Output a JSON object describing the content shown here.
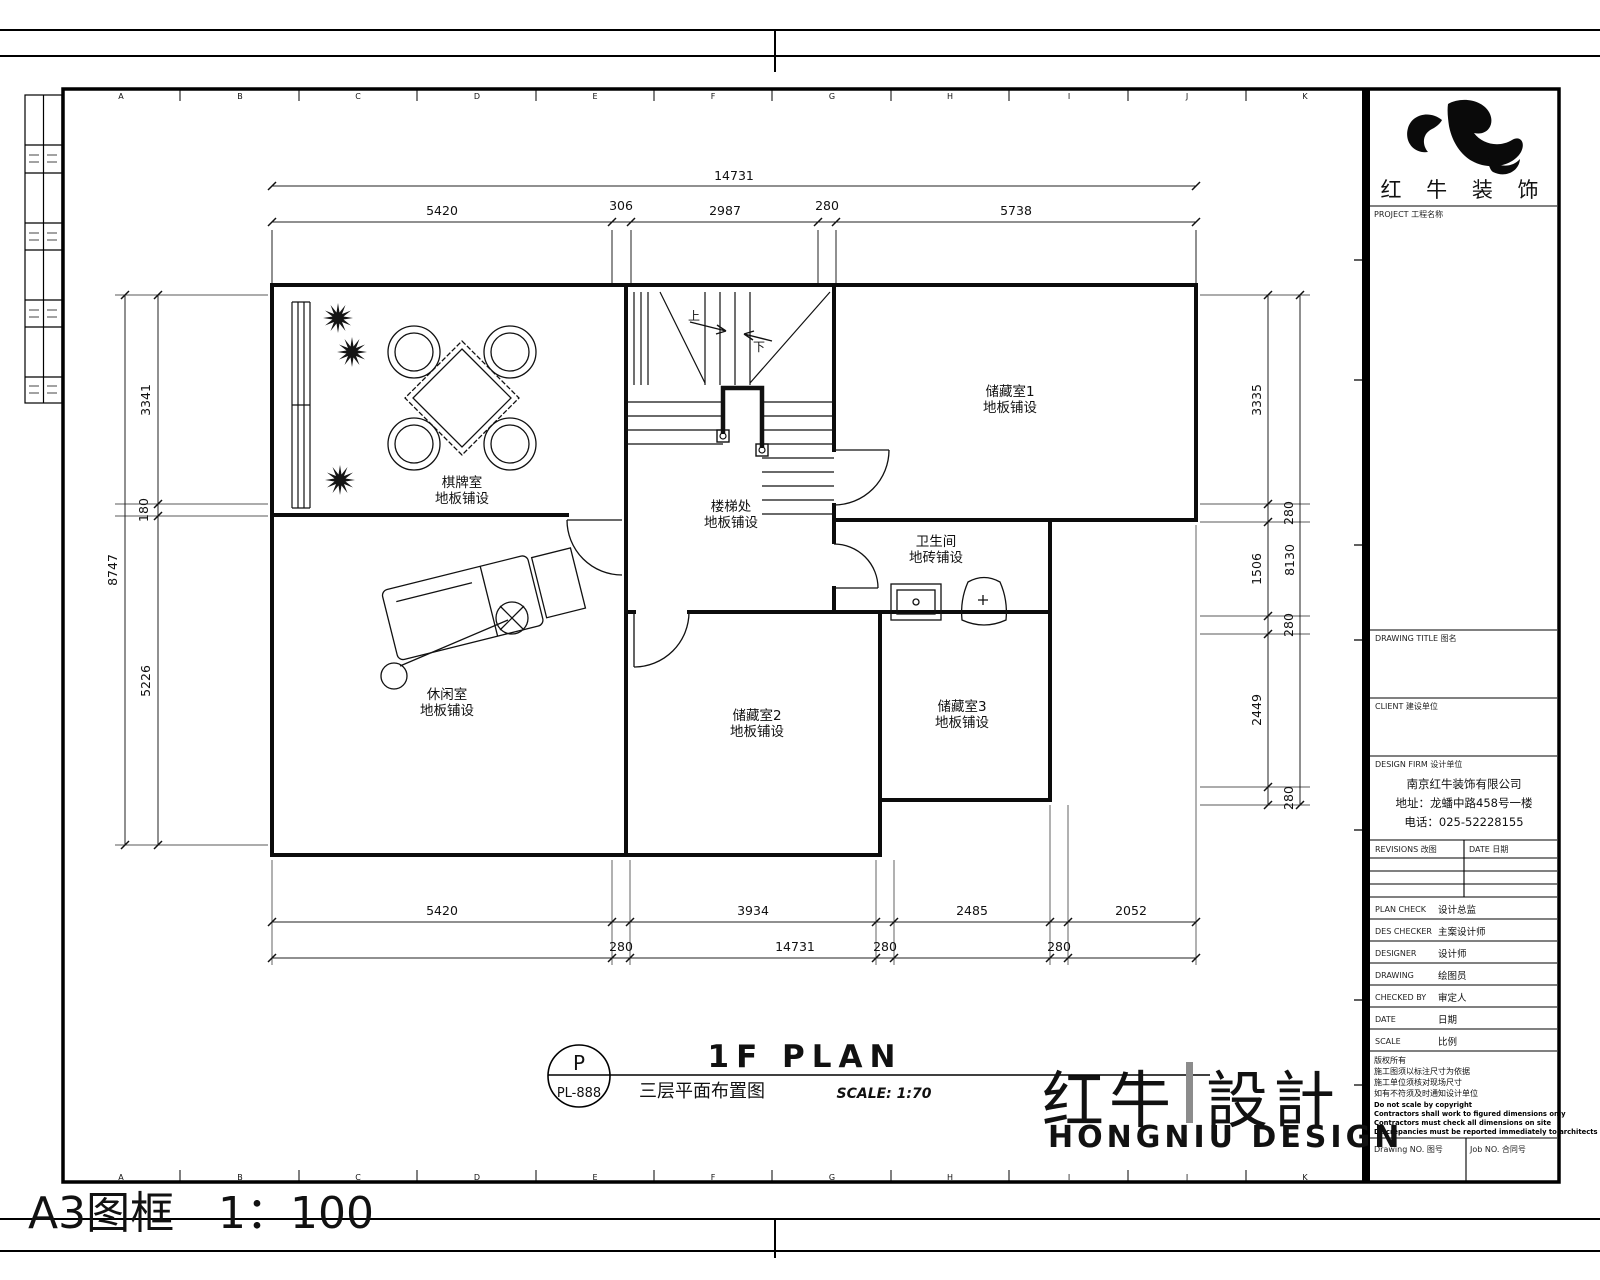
{
  "sheet": {
    "grid_letters": [
      "A",
      "B",
      "C",
      "D",
      "E",
      "F",
      "G",
      "H",
      "I",
      "J",
      "K"
    ],
    "footer": {
      "frame_label": "A3图框",
      "frame_scale": "1：100"
    }
  },
  "header_logo": {
    "brand_chars": "红 牛 装 饰",
    "project_label": "PROJECT 工程名称"
  },
  "brand_mark": {
    "cn_left": "红牛",
    "cn_right": "設計",
    "watermark": "HONGNIU DESIGN"
  },
  "title_block": {
    "drawing_title_label": "DRAWING TITLE 图名",
    "client_label": "CLIENT 建设单位",
    "design_firm_label": "DESIGN FIRM 设计单位",
    "company_lines": [
      "南京红牛装饰有限公司",
      "地址：龙蟠中路458号一楼",
      "电话：025-52228155"
    ],
    "revisions_label": "REVISIONS 改图",
    "revisions_date_label": "DATE 日期",
    "staff_rows": [
      {
        "label": "PLAN CHECK",
        "value": "设计总监"
      },
      {
        "label": "DES CHECKER",
        "value": "主案设计师"
      },
      {
        "label": "DESIGNER",
        "value": "设计师"
      },
      {
        "label": "DRAWING",
        "value": "绘图员"
      },
      {
        "label": "CHECKED BY",
        "value": "审定人"
      },
      {
        "label": "DATE",
        "value": "日期"
      },
      {
        "label": "SCALE",
        "value": "比例"
      }
    ],
    "notes_cn": [
      "版权所有",
      "施工图须以标注尺寸为依据",
      "施工单位须核对现场尺寸",
      "如有不符须及时通知设计单位"
    ],
    "notes_en": [
      "Do not scale by copyright",
      "Contractors shall work to figured dimensions only",
      "Contractors must check all dimensions on site",
      "Discrepancies must be reported immediately to architects"
    ],
    "drawing_no_label": "Drawing NO. 图号",
    "job_no_label": "Job NO. 合同号"
  },
  "plan_title": {
    "bubble_letter": "P",
    "bubble_code": "PL-888",
    "cn": "三层平面布置图",
    "en": "1F PLAN",
    "scale": "SCALE: 1:70"
  },
  "rooms": [
    {
      "name": "棋牌室",
      "finish": "地板铺设"
    },
    {
      "name": "储藏室1",
      "finish": "地板铺设"
    },
    {
      "name": "楼梯处",
      "finish": "地板铺设"
    },
    {
      "name": "卫生间",
      "finish": "地砖铺设"
    },
    {
      "name": "休闲室",
      "finish": "地板铺设"
    },
    {
      "name": "储藏室2",
      "finish": "地板铺设"
    },
    {
      "name": "储藏室3",
      "finish": "地板铺设"
    }
  ],
  "stairs": {
    "up": "上",
    "down": "下"
  },
  "dimensions": {
    "top_total": "14731",
    "top_segments": [
      "5420",
      "306",
      "2987",
      "280",
      "5738"
    ],
    "bottom_segments": [
      "5420",
      "3934",
      "2485",
      "2052"
    ],
    "bottom_gaps": [
      "280",
      "280",
      "280"
    ],
    "bottom_total": "14731",
    "left_total": "8747",
    "left_segments": [
      "3341",
      "180",
      "5226"
    ],
    "right_segments": [
      "3335",
      "1506",
      "2449"
    ],
    "right_gaps": [
      "280",
      "280",
      "280"
    ],
    "right_total": "8130"
  }
}
